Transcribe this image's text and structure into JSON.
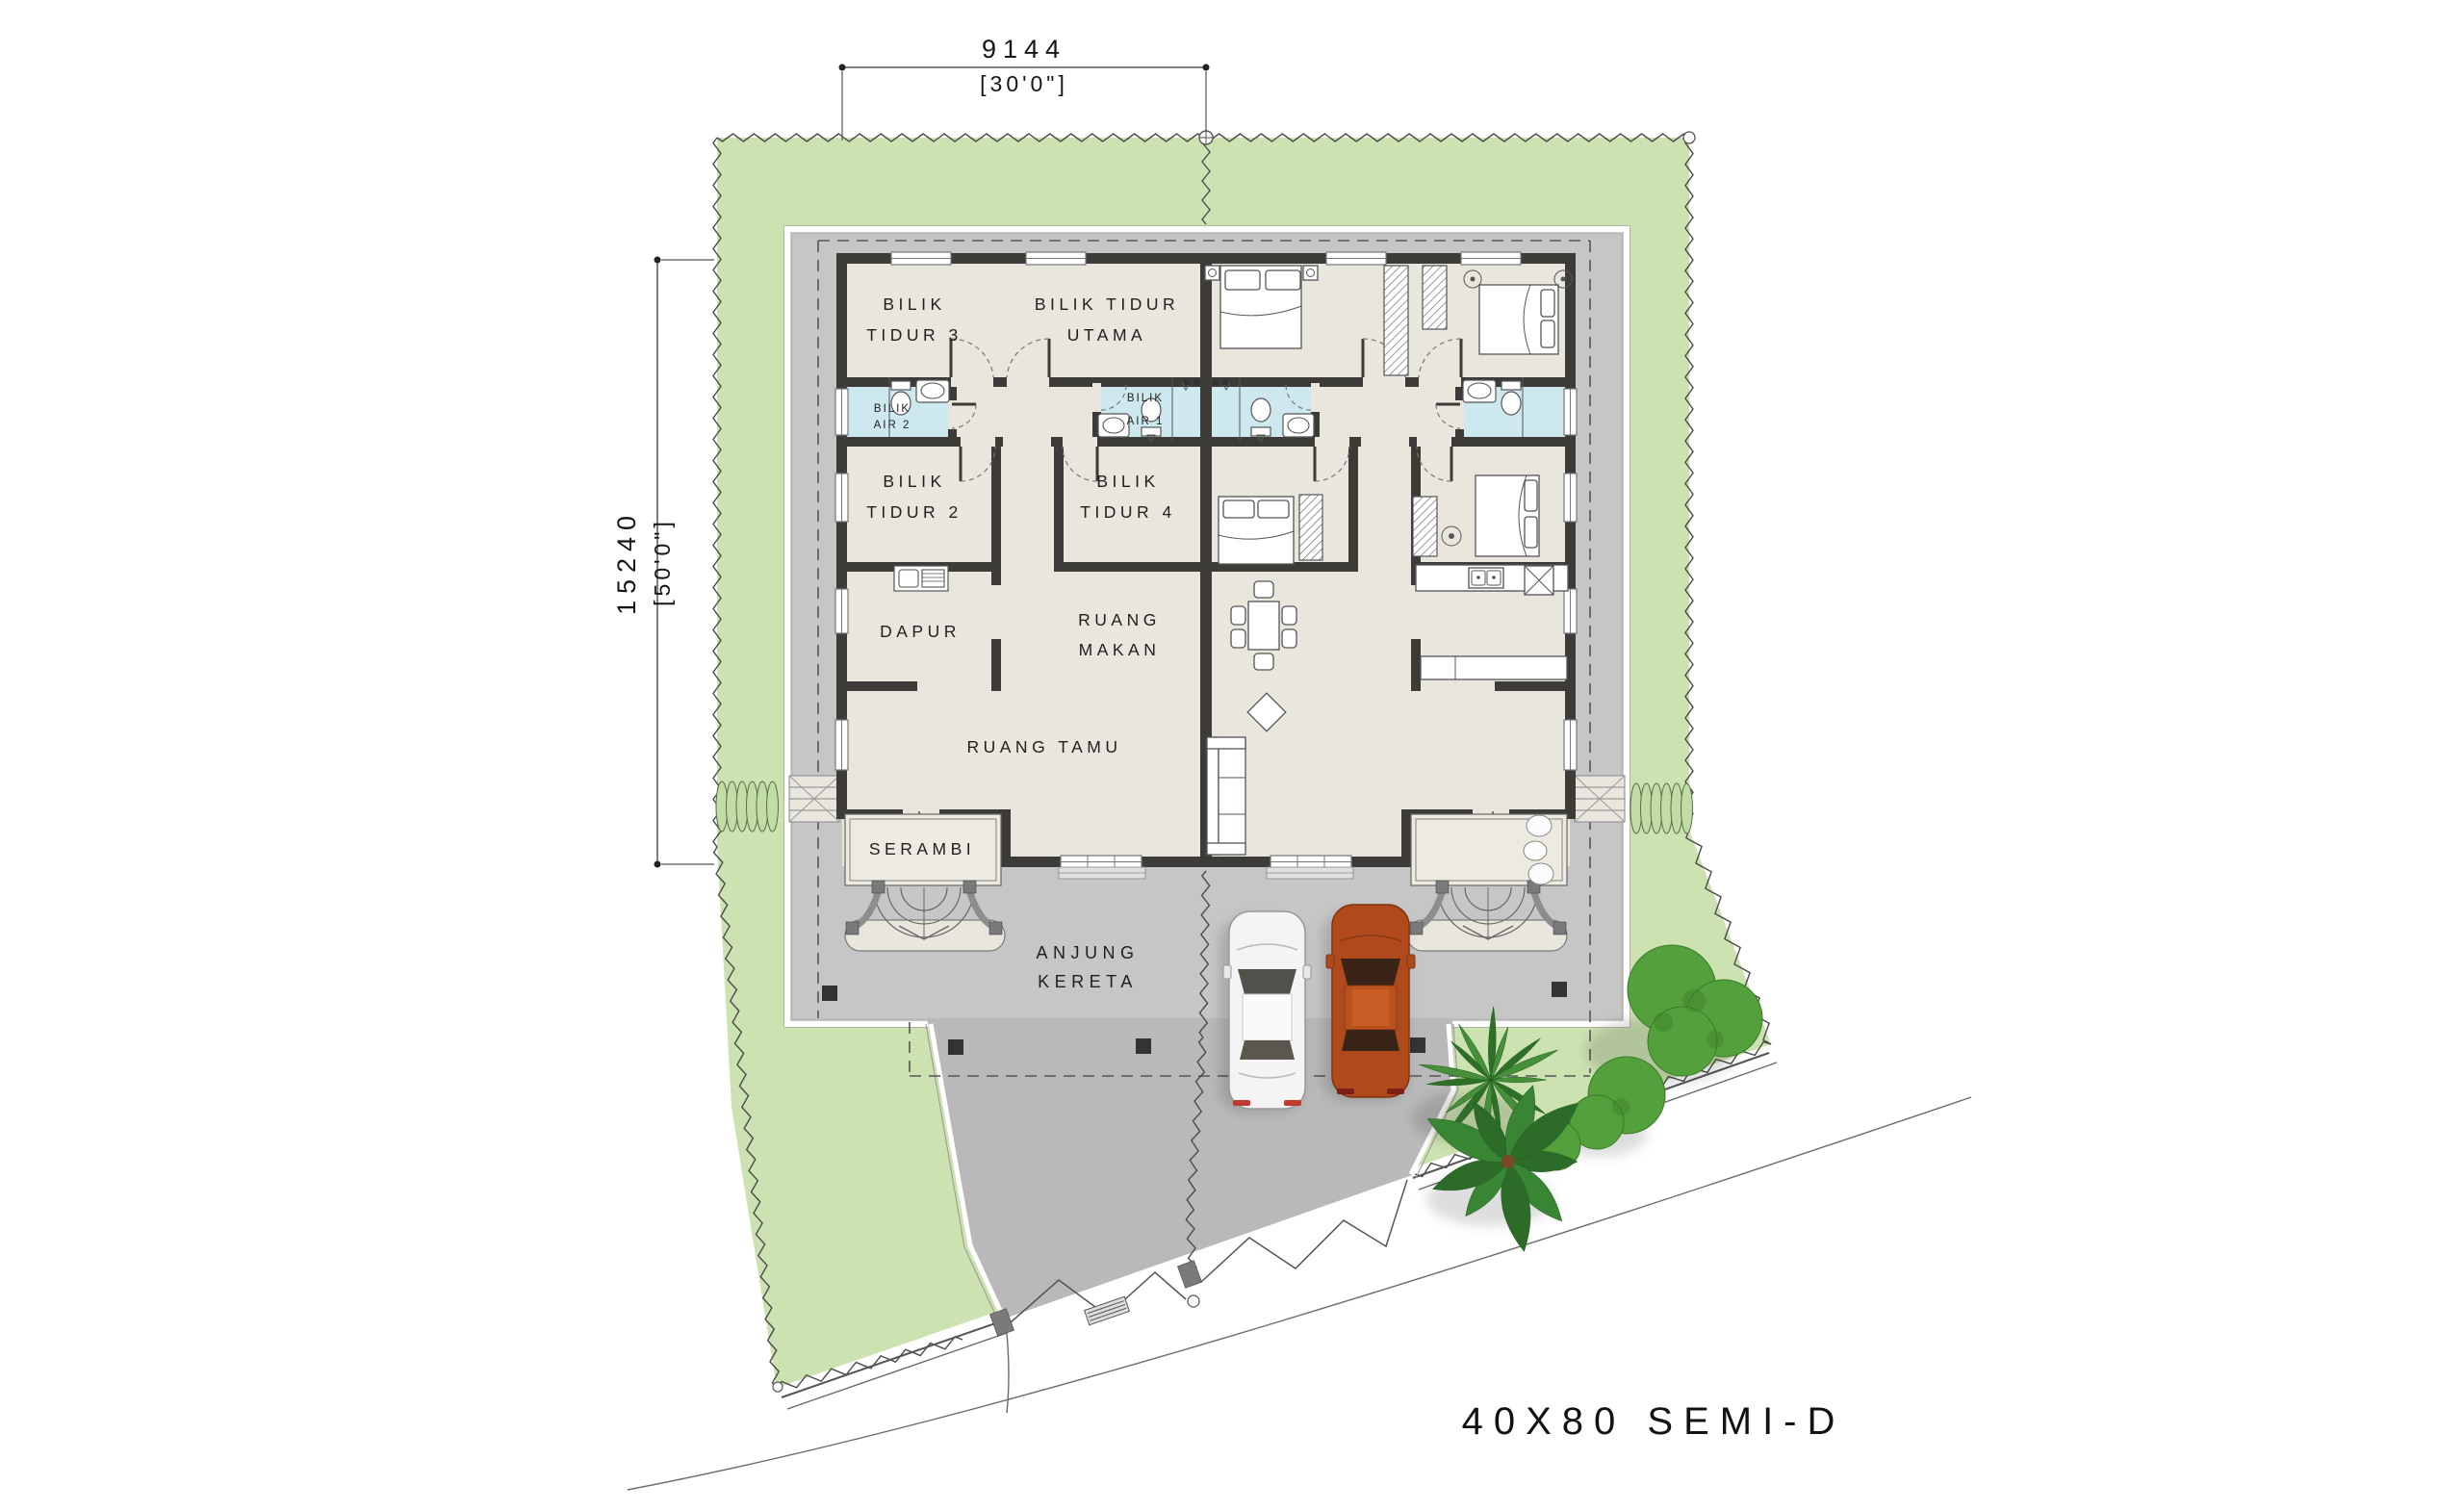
{
  "title": "40X80 SEMI-D",
  "dimensions": {
    "width_mm": "9144",
    "width_ft": "[30'0\"]",
    "depth_mm": "15240",
    "depth_ft": "[50'0\"]"
  },
  "rooms": {
    "bilik_tidur_3": [
      "BILIK",
      "TIDUR 3"
    ],
    "bilik_tidur_utama": [
      "BILIK TIDUR",
      "UTAMA"
    ],
    "bilik_air_2": [
      "BILIK",
      "AIR 2"
    ],
    "bilik_air_1": [
      "BILIK",
      "AIR 1"
    ],
    "bilik_tidur_2": [
      "BILIK",
      "TIDUR 2"
    ],
    "bilik_tidur_4": [
      "BILIK",
      "TIDUR 4"
    ],
    "dapur": [
      "DAPUR"
    ],
    "ruang_makan": [
      "RUANG",
      "MAKAN"
    ],
    "ruang_tamu": [
      "RUANG TAMU"
    ],
    "serambi": [
      "SERAMBI"
    ],
    "anjung_kereta": [
      "ANJUNG",
      "KERETA"
    ]
  },
  "colors": {
    "lawn": "#cde2b1",
    "paving": "#c6c6c6",
    "driveway": "#b9b9b9",
    "floor": "#e9e6de",
    "bathroom": "#cde8ee",
    "wall": "#3d3b38",
    "car_white": "#f4f4f4",
    "car_orange": "#b04a1d",
    "shrub": "#54a03c"
  }
}
